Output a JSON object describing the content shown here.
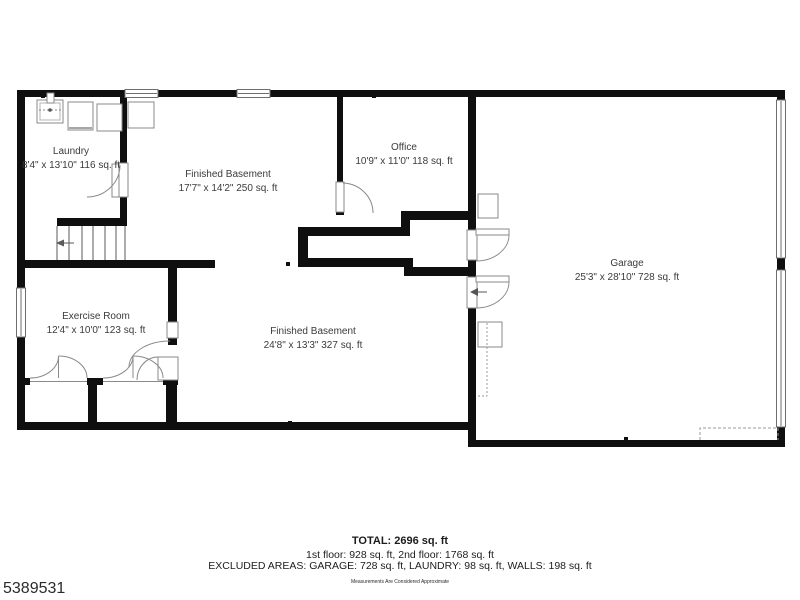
{
  "rooms": {
    "laundry": {
      "name": "Laundry",
      "dims": "8'4\" x 13'10\" 116 sq. ft"
    },
    "basement_upper": {
      "name": "Finished Basement",
      "dims": "17'7\" x 14'2\" 250 sq. ft"
    },
    "office": {
      "name": "Office",
      "dims": "10'9\" x 11'0\" 118 sq. ft"
    },
    "garage": {
      "name": "Garage",
      "dims": "25'3\" x 28'10\" 728 sq. ft"
    },
    "exercise": {
      "name": "Exercise Room",
      "dims": "12'4\" x 10'0\" 123 sq. ft"
    },
    "basement_lower": {
      "name": "Finished Basement",
      "dims": "24'8\" x 13'3\" 327 sq. ft"
    }
  },
  "summary": {
    "total": "TOTAL: 2696 sq. ft",
    "floors": "1st floor: 928 sq. ft, 2nd floor: 1768 sq. ft",
    "excluded": "EXCLUDED AREAS: GARAGE: 728 sq. ft, LAUNDRY: 98 sq. ft, WALLS: 198 sq. ft",
    "disclaimer": "Measurements Are Considered Approximate"
  },
  "listing_id": "5389531",
  "colors": {
    "wall": "#0f0f0f",
    "fixture_line": "#8a8a8a",
    "text": "#3b3b3b"
  }
}
